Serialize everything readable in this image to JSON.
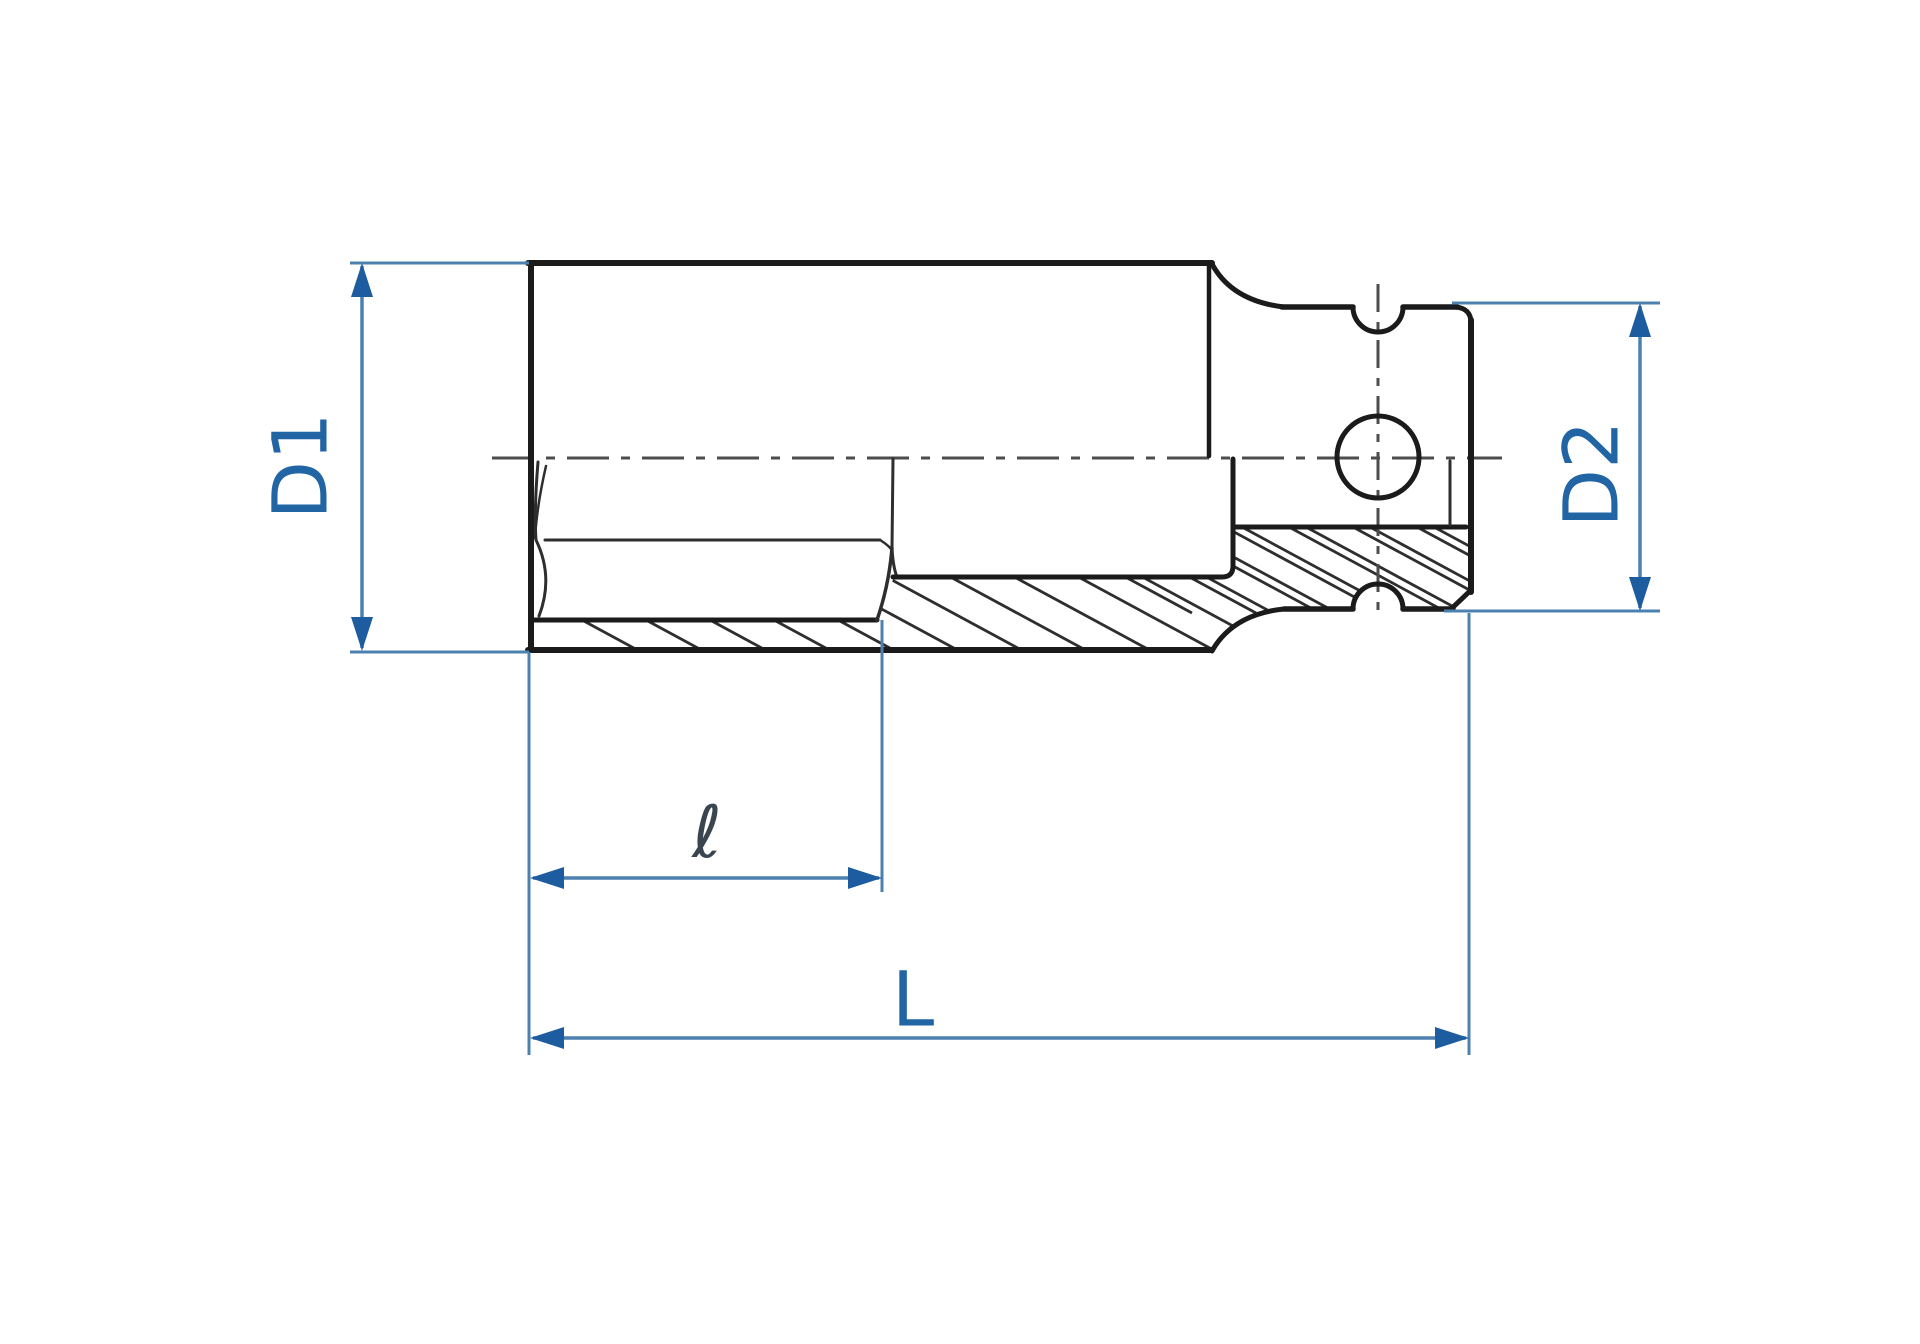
{
  "diagram": {
    "type": "technical-drawing",
    "subject": "deep impact socket cross-section",
    "labels": {
      "d1": "D1",
      "d2": "D2",
      "sleeve_length": "ℓ",
      "total_length": "L"
    },
    "colors": {
      "background": "#ffffff",
      "outline_black": "#1b1b1b",
      "thin_line": "#2e2e2e",
      "centerline_gray": "#4d4d4d",
      "dimension_line_blue": "#4b80af",
      "arrow_blue": "#1d5c9f",
      "label_blue": "#2265a5",
      "script_label_color": "#3a4550"
    }
  }
}
